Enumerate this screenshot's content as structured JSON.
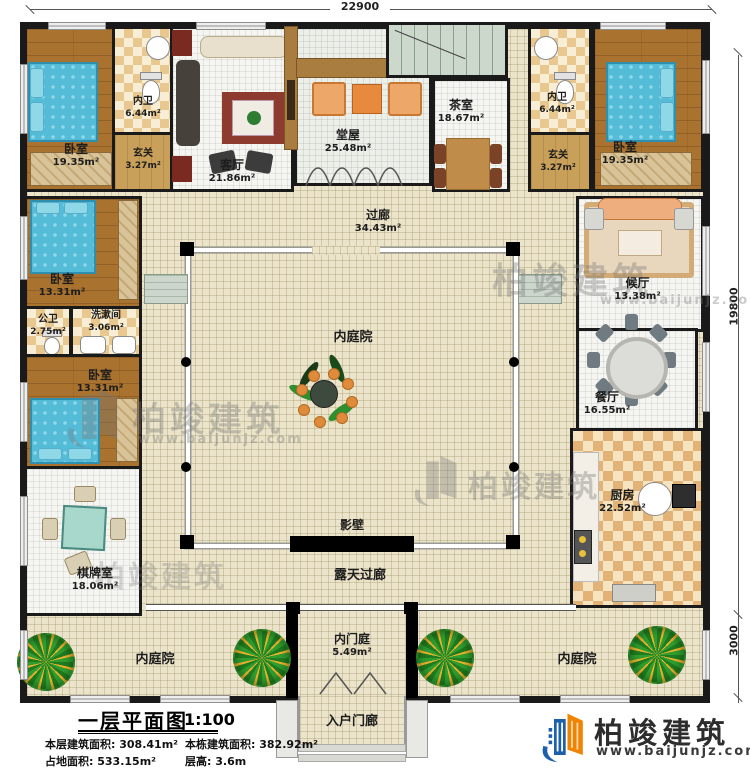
{
  "title_block": {
    "title": "一层平面图",
    "scale": "1:100",
    "stats": [
      {
        "label": "本层建筑面积:",
        "value": "308.41m²"
      },
      {
        "label": "本栋建筑面积:",
        "value": "382.92m²"
      },
      {
        "label": "占地面积:",
        "value": "533.15m²"
      },
      {
        "label": "层高:",
        "value": "3.6m"
      }
    ]
  },
  "dimensions": {
    "top": "22900",
    "right": "19800",
    "right_lower": "3000"
  },
  "brand": {
    "name": "柏竣建筑",
    "url": "www.baijunjz.com"
  },
  "rooms": {
    "bedroom_tl": {
      "label": "卧室",
      "area": "19.35m²"
    },
    "bath_tl": {
      "label": "内卫",
      "area": "6.44m²"
    },
    "foyer_tl": {
      "label": "玄关",
      "area": "3.27m²"
    },
    "living": {
      "label": "客厅",
      "area": "21.86m²"
    },
    "hall": {
      "label": "堂屋",
      "area": "25.48m²"
    },
    "tea": {
      "label": "茶室",
      "area": "18.67m²"
    },
    "bath_tr": {
      "label": "内卫",
      "area": "6.44m²"
    },
    "foyer_tr": {
      "label": "玄关",
      "area": "3.27m²"
    },
    "bedroom_tr": {
      "label": "卧室",
      "area": "19.35m²"
    },
    "bedroom_ml": {
      "label": "卧室",
      "area": "13.31m²"
    },
    "public_bath": {
      "label": "公卫",
      "area": "2.75m²"
    },
    "washroom": {
      "label": "洗漱间",
      "area": "3.06m²"
    },
    "bedroom_bl": {
      "label": "卧室",
      "area": "13.31m²"
    },
    "game_room": {
      "label": "棋牌室",
      "area": "18.06m²"
    },
    "waiting": {
      "label": "候厅",
      "area": "13.38m²"
    },
    "dining": {
      "label": "餐厅",
      "area": "16.55m²"
    },
    "kitchen": {
      "label": "厨房",
      "area": "22.52m²"
    },
    "corridor": {
      "label": "过廊",
      "area": "34.43m²"
    },
    "inner_courtyard": {
      "label": "内庭院"
    },
    "screen_wall": {
      "label": "影壁"
    },
    "open_corridor": {
      "label": "露天过廊"
    },
    "inner_gate": {
      "label": "内门庭",
      "area": "5.49m²"
    },
    "courtyard_bottom_left": {
      "label": "内庭院"
    },
    "courtyard_bottom_right": {
      "label": "内庭院"
    },
    "entry_porch": {
      "label": "入户门廊"
    },
    "stairs_up": {
      "label": "上"
    }
  },
  "colors": {
    "wall": "#1a1a1a",
    "wood_floor": "#a9732f",
    "checker_tile": "#e9c88f",
    "courtyard": "#ebe4ca",
    "brand_blue": "#1c5fab",
    "brand_orange": "#f08300"
  }
}
